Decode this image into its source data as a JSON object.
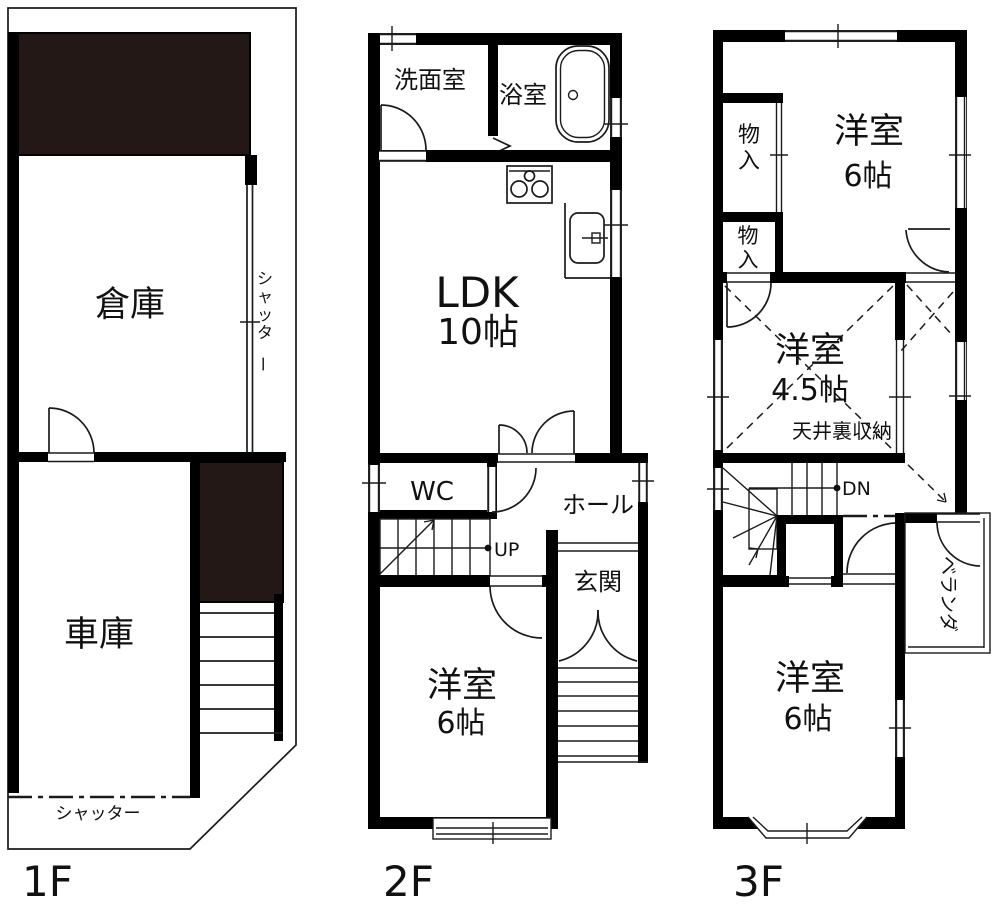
{
  "colors": {
    "wall": "#000000",
    "dark_fill": "#231815",
    "line": "#1b1b1b",
    "background": "#ffffff"
  },
  "floor1": {
    "name": "1F",
    "souko": "倉庫",
    "shako": "車庫",
    "shutter_right": "シャッター",
    "shutter_bottom": "シャッター"
  },
  "floor2": {
    "name": "2F",
    "senmenshitsu": "洗面室",
    "yokushitsu": "浴室",
    "ldk": "LDK",
    "ldk_size": "10帖",
    "wc": "WC",
    "hall": "ホール",
    "genkan": "玄関",
    "up": "UP",
    "yoshitsu": "洋室",
    "yoshitsu_size": "6帖"
  },
  "floor3": {
    "name": "3F",
    "monoire1": "物入",
    "monoire2": "物入",
    "yoshitsu_north": "洋室",
    "yoshitsu_north_size": "6帖",
    "yoshitsu_center": "洋室",
    "yoshitsu_center_size": "4.5帖",
    "attic": "天井裏収納",
    "dn": "DN",
    "veranda": "ベランダ",
    "yoshitsu_south": "洋室",
    "yoshitsu_south_size": "6帖"
  }
}
